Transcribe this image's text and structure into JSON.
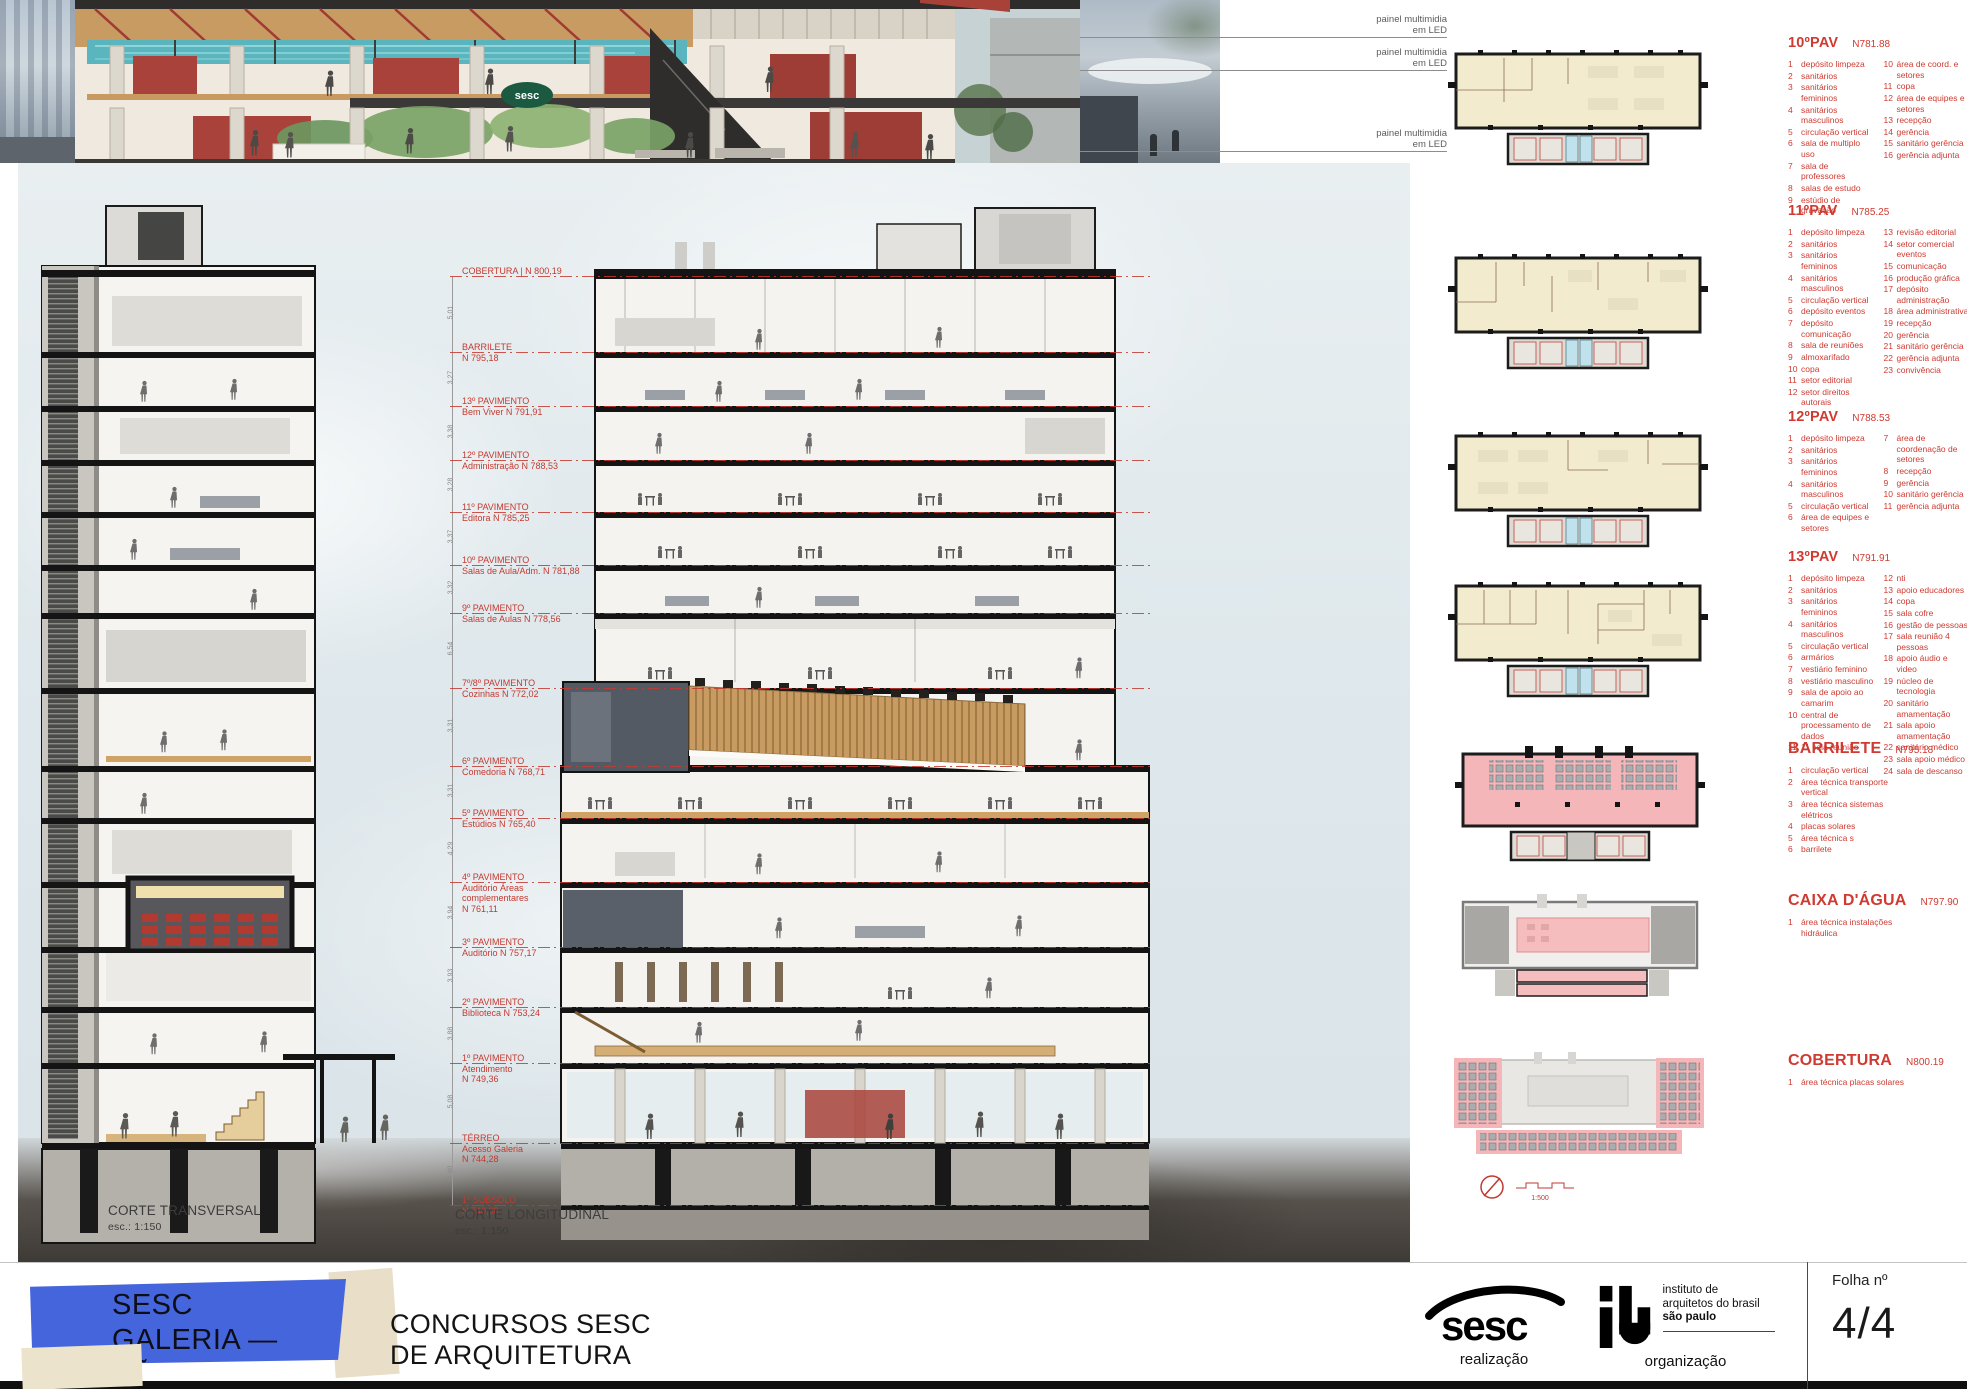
{
  "top": {
    "led_label": "painel multimidia",
    "led_label2": "em LED",
    "caption": "CORTE TÉRREO E 1º PAVIMENTO",
    "sesc_sign": "sesc"
  },
  "sections": {
    "transversal_title": "CORTE TRANSVERSAL",
    "transversal_scale": "esc.: 1:150",
    "longitudinal_title": "CORTE LONGITUDINAL",
    "longitudinal_scale": "esc.: 1:150"
  },
  "levels": [
    {
      "l1": "COBERTURA | N 800,19"
    },
    {
      "l1": "BARRILETE",
      "l2": "N 795,18"
    },
    {
      "l1": "13º PAVIMENTO",
      "l2": "Bem Viver N 791,91"
    },
    {
      "l1": "12º PAVIMENTO",
      "l2": "Administração N 788,53"
    },
    {
      "l1": "11º PAVIMENTO",
      "l2": "Editora N 785,25"
    },
    {
      "l1": "10º PAVIMENTO",
      "l2": "Salas de Aula/Adm.  N 781,88"
    },
    {
      "l1": "9º PAVIMENTO",
      "l2": "Salas de Aulas N 778,56"
    },
    {
      "l1": "7º/8º PAVIMENTO",
      "l2": "Cozinhas N 772,02"
    },
    {
      "l1": "6º PAVIMENTO",
      "l2": "Comedoria N 768,71"
    },
    {
      "l1": "5º PAVIMENTO",
      "l2": "Estúdios N 765,40"
    },
    {
      "l1": "4º PAVIMENTO",
      "l2": "Auditório  Áreas",
      "l3": "complementares",
      "l4": "N 761,11"
    },
    {
      "l1": "3º PAVIMENTO",
      "l2": "Auditório  N 757,17"
    },
    {
      "l1": "2º PAVIMENTO",
      "l2": "Biblioteca  N 753,24"
    },
    {
      "l1": "1º PAVIMENTO",
      "l2": "Atendimento",
      "l4": "N 749,36"
    },
    {
      "l1": "TÉRREO",
      "l2": "Acesso Galeria",
      "l4": "N 744,28"
    },
    {
      "l1": "1º SUBSOLO",
      "l2": "N 740,38"
    }
  ],
  "dims": [
    "5,01",
    "3,27",
    "3,38",
    "3,28",
    "3,37",
    "3,32",
    "6,54",
    "3,31",
    "3,31",
    "4,29",
    "3,94",
    "3,93",
    "3,88",
    "5,08",
    "3,90"
  ],
  "plans": [
    {
      "title": "10ºPAV",
      "level": "N781.88",
      "col1": [
        {
          "n": "1",
          "t": "depósito limpeza"
        },
        {
          "n": "2",
          "t": "sanitários"
        },
        {
          "n": "3",
          "t": "sanitários femininos"
        },
        {
          "n": "4",
          "t": "sanitários masculinos"
        },
        {
          "n": "5",
          "t": "circulação vertical"
        },
        {
          "n": "6",
          "t": "sala de multiplo uso"
        },
        {
          "n": "7",
          "t": "sala de professores"
        },
        {
          "n": "8",
          "t": "salas de estudo"
        },
        {
          "n": "9",
          "t": "estúdio de gravação"
        }
      ],
      "col2": [
        {
          "n": "10",
          "t": "área de coord. e setores"
        },
        {
          "n": "11",
          "t": "copa"
        },
        {
          "n": "12",
          "t": "área de equipes e setores"
        },
        {
          "n": "13",
          "t": "recepção"
        },
        {
          "n": "14",
          "t": "gerência"
        },
        {
          "n": "15",
          "t": "sanitário gerência"
        },
        {
          "n": "16",
          "t": "gerência adjunta"
        }
      ]
    },
    {
      "title": "11ºPAV",
      "level": "N785.25",
      "col1": [
        {
          "n": "1",
          "t": "depósito limpeza"
        },
        {
          "n": "2",
          "t": "sanitários"
        },
        {
          "n": "3",
          "t": "sanitários femininos"
        },
        {
          "n": "4",
          "t": "sanitários masculinos"
        },
        {
          "n": "5",
          "t": "circulação vertical"
        },
        {
          "n": "6",
          "t": "depósito eventos"
        },
        {
          "n": "7",
          "t": "depósito comunicação"
        },
        {
          "n": "8",
          "t": "sala de reuniões"
        },
        {
          "n": "9",
          "t": "almoxarifado"
        },
        {
          "n": "10",
          "t": "copa"
        },
        {
          "n": "11",
          "t": "setor editorial"
        },
        {
          "n": "12",
          "t": "setor direitos autorais"
        }
      ],
      "col2": [
        {
          "n": "13",
          "t": "revisão editorial"
        },
        {
          "n": "14",
          "t": "setor comercial eventos"
        },
        {
          "n": "15",
          "t": "comunicação"
        },
        {
          "n": "16",
          "t": "produção gráfica"
        },
        {
          "n": "17",
          "t": "depósito administração"
        },
        {
          "n": "18",
          "t": "área administrativa"
        },
        {
          "n": "19",
          "t": "recepção"
        },
        {
          "n": "20",
          "t": "gerência"
        },
        {
          "n": "21",
          "t": "sanitário gerência"
        },
        {
          "n": "22",
          "t": "gerência adjunta"
        },
        {
          "n": "23",
          "t": "convivência"
        }
      ]
    },
    {
      "title": "12ºPAV",
      "level": "N788.53",
      "col1": [
        {
          "n": "1",
          "t": "depósito limpeza"
        },
        {
          "n": "2",
          "t": "sanitários"
        },
        {
          "n": "3",
          "t": "sanitários femininos"
        },
        {
          "n": "4",
          "t": "sanitários masculinos"
        },
        {
          "n": "5",
          "t": "circulação vertical"
        },
        {
          "n": "6",
          "t": "área de equipes e setores"
        }
      ],
      "col2": [
        {
          "n": "7",
          "t": "área de coordenação de setores"
        },
        {
          "n": "8",
          "t": "recepção"
        },
        {
          "n": "9",
          "t": "gerência"
        },
        {
          "n": "10",
          "t": "sanitário gerência"
        },
        {
          "n": "11",
          "t": "gerência adjunta"
        }
      ]
    },
    {
      "title": "13ºPAV",
      "level": "N791.91",
      "col1": [
        {
          "n": "1",
          "t": "depósito limpeza"
        },
        {
          "n": "2",
          "t": "sanitários"
        },
        {
          "n": "3",
          "t": "sanitários femininos"
        },
        {
          "n": "4",
          "t": "sanitários masculinos"
        },
        {
          "n": "5",
          "t": "circulação vertical"
        },
        {
          "n": "6",
          "t": "armários"
        },
        {
          "n": "7",
          "t": "vestiário feminino"
        },
        {
          "n": "8",
          "t": "vestiário masculino"
        },
        {
          "n": "9",
          "t": "sala de apoio ao camarim"
        },
        {
          "n": "10",
          "t": "central de processamento de dados"
        },
        {
          "n": "11",
          "t": "11 sala reunião"
        }
      ],
      "col2": [
        {
          "n": "12",
          "t": "nti"
        },
        {
          "n": "13",
          "t": "apoio educadores"
        },
        {
          "n": "14",
          "t": "copa"
        },
        {
          "n": "15",
          "t": "sala cofre"
        },
        {
          "n": "16",
          "t": "gestão de pessoas"
        },
        {
          "n": "17",
          "t": "sala reunião 4 pessoas"
        },
        {
          "n": "18",
          "t": "apoio áudio e video"
        },
        {
          "n": "19",
          "t": "núcleo de tecnologia"
        },
        {
          "n": "20",
          "t": "sanitário amamentação"
        },
        {
          "n": "21",
          "t": "sala apoio amamentação"
        },
        {
          "n": "22",
          "t": "sanitário médico"
        },
        {
          "n": "23",
          "t": "sala apoio médico"
        },
        {
          "n": "24",
          "t": "sala de descanso"
        }
      ]
    },
    {
      "title": "BARRILETE",
      "level": "N795.18",
      "col1": [
        {
          "n": "1",
          "t": "circulação vertical"
        },
        {
          "n": "2",
          "t": "área técnica transporte vertical"
        },
        {
          "n": "3",
          "t": "área técnica sistemas elétricos"
        },
        {
          "n": "4",
          "t": "placas solares"
        },
        {
          "n": "5",
          "t": "área técnica s"
        },
        {
          "n": "6",
          "t": "barrilete"
        }
      ],
      "col2": []
    },
    {
      "title": "CAIXA D'ÁGUA",
      "level": "N797.90",
      "col1": [
        {
          "n": "1",
          "t": "área técnica instalações hidráulica"
        }
      ],
      "col2": []
    },
    {
      "title": "COBERTURA",
      "level": "N800.19",
      "col1": [
        {
          "n": "1",
          "t": "área técnica placas solares"
        }
      ],
      "col2": []
    }
  ],
  "scalebar": "1:500",
  "footer": {
    "flag_line1": "SESC",
    "flag_line2": "GALERIA — SÃO PAULO",
    "competition_line1": "CONCURSOS SESC",
    "competition_line2": "DE ARQUITETURA",
    "sesc_logo": "sesc",
    "sesc_role": "realização",
    "iab_name_l1": "instituto de",
    "iab_name_l2": "arquitetos do brasil",
    "iab_name_l3": "são paulo",
    "iab_role": "organização",
    "folha_label": "Folha nº",
    "folha_value": "4/4"
  }
}
